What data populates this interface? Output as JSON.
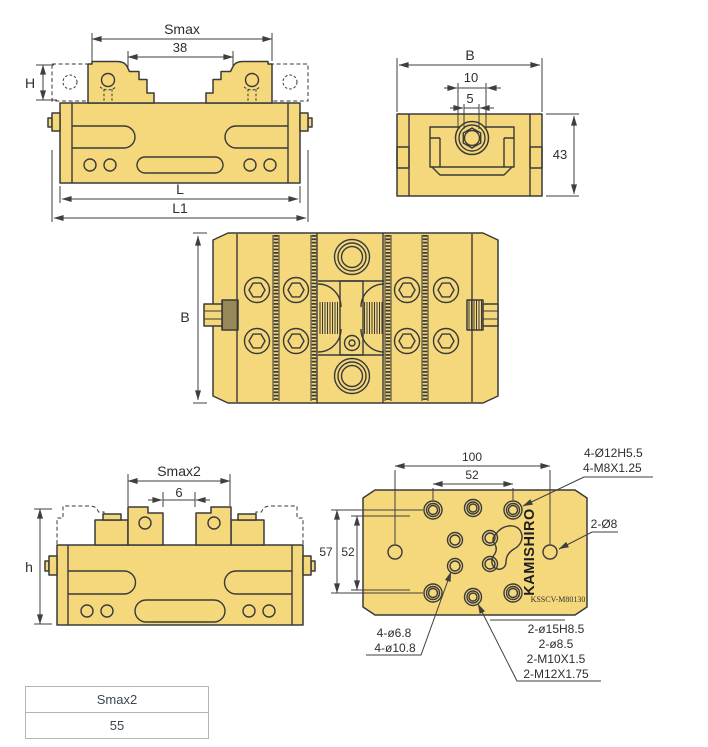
{
  "views": {
    "front": {
      "smax": "Smax",
      "jaw_opening": "38",
      "height_label": "H",
      "length_label": "L",
      "overall_length_label": "L1"
    },
    "end": {
      "width_label": "B",
      "dim_10": "10",
      "dim_5": "5",
      "dim_43": "43"
    },
    "plan": {
      "width_label": "B"
    },
    "reversed": {
      "smax2": "Smax2",
      "dim_6": "6",
      "height_label": "h"
    },
    "bottom": {
      "dim_100": "100",
      "dim_52_top": "52",
      "dim_57": "57",
      "dim_52_left": "52",
      "callout_corner_line1": "4-Ø12H5.5",
      "callout_corner_line2": "4-M8X1.25",
      "callout_side": "2-Ø8",
      "callout_cluster_line1": "4-ø6.8",
      "callout_cluster_line2": "4-ø10.8",
      "callout_center_line1": "2-ø15H8.5",
      "callout_center_line2": "2-ø8.5",
      "callout_center_line3": "2-M10X1.5",
      "callout_center_line4": "2-M12X1.75",
      "brand": "KAMISHIRO",
      "model_code": "KSSCV-M80130"
    }
  },
  "spec_table": {
    "header": "Smax2",
    "value": "55"
  },
  "colors": {
    "body_fill": "#F5D87C",
    "line": "#3A3A3A"
  }
}
